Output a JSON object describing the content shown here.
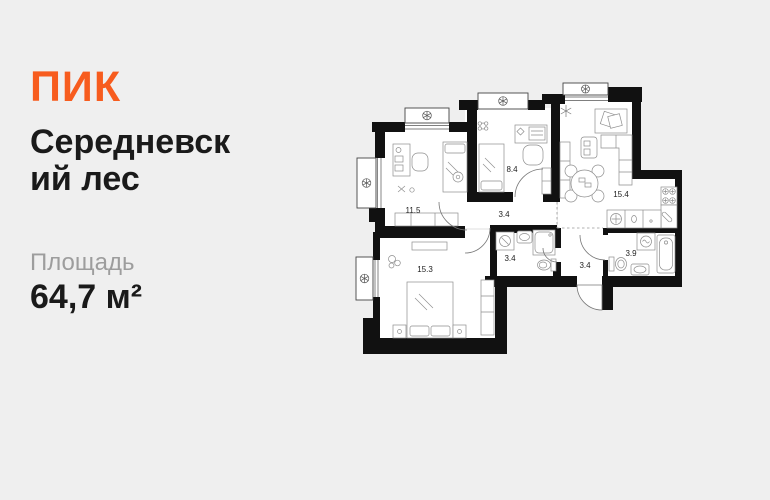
{
  "colors": {
    "background": "#efefef",
    "brand_orange": "#F75C1E",
    "title_color": "#1a1a1a",
    "muted_gray": "#9d9d9d",
    "plan_walls": "#111111",
    "plan_floor": "#ffffff",
    "plan_furniture": "#8e8e8e"
  },
  "brand": {
    "logo_text": "ПИК"
  },
  "listing": {
    "title_line1": "Середневск",
    "title_line2": "ий лес",
    "area_label": "Площадь",
    "area_value": "64,7 м²"
  },
  "floorplan": {
    "rooms": [
      {
        "name": "bedroom",
        "area": "11.5"
      },
      {
        "name": "bedroom-2",
        "area": "8.4"
      },
      {
        "name": "kitchen-living",
        "area": "15.4"
      },
      {
        "name": "corridor",
        "area": "3.4"
      },
      {
        "name": "bathroom",
        "area": "3.4"
      },
      {
        "name": "entrance-hall",
        "area": "3.4"
      },
      {
        "name": "bathroom-2",
        "area": "3.9"
      },
      {
        "name": "bedroom-master",
        "area": "15.3"
      }
    ]
  }
}
